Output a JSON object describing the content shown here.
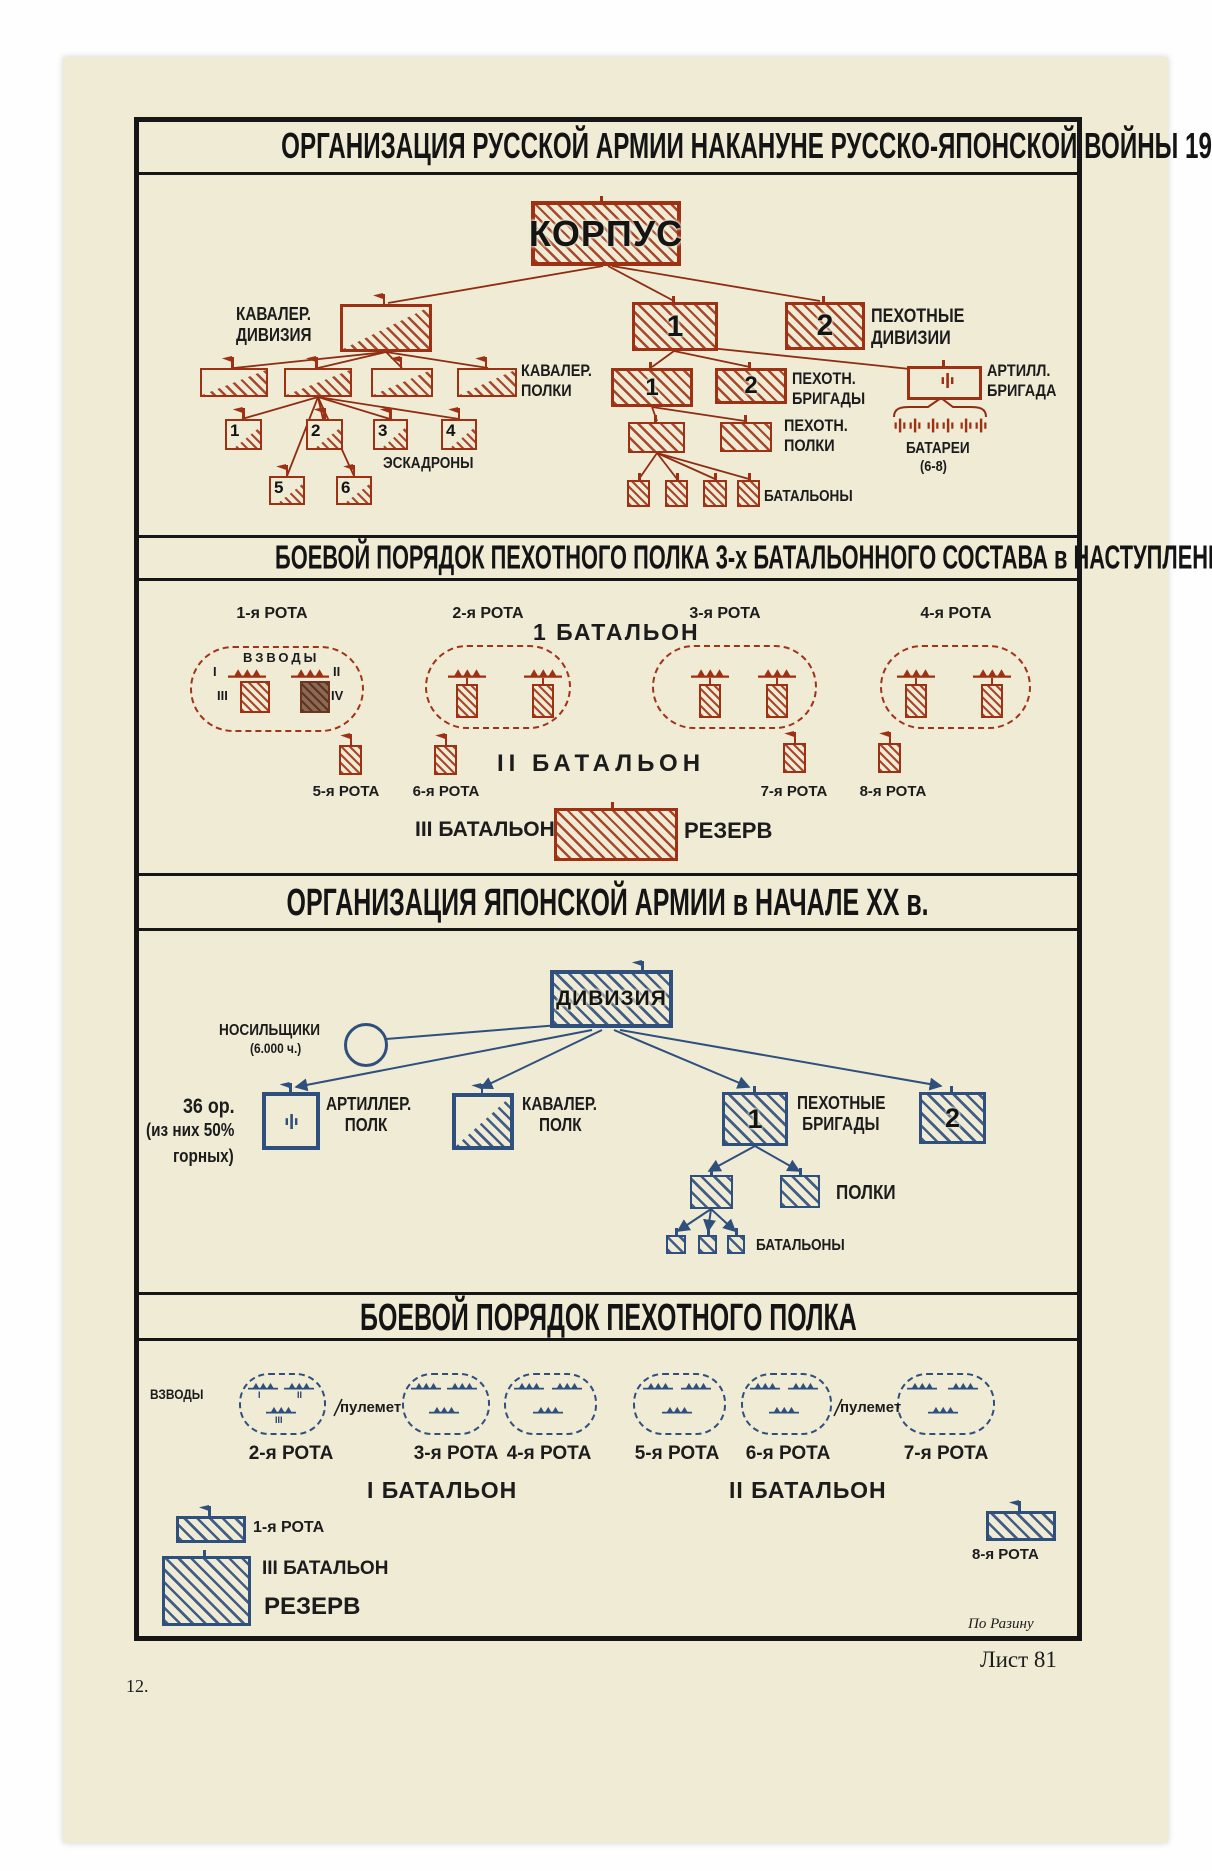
{
  "colors": {
    "paper": "#efebd5",
    "red_ink": "#9e3014",
    "blue_ink": "#2f4f7d",
    "text_ink": "#1c1c1c"
  },
  "titles": {
    "s1": "ОРГАНИЗАЦИЯ РУССКОЙ АРМИИ НАКАНУНЕ РУССКО-ЯПОНСКОЙ ВОЙНЫ 1904-5г.г.",
    "s2": "БОЕВОЙ ПОРЯДОК ПЕХОТНОГО ПОЛКА 3-х БАТАЛЬОННОГО СОСТАВА в НАСТУПЛЕНИИ",
    "s3": "ОРГАНИЗАЦИЯ ЯПОНСКОЙ АРМИИ в НАЧАЛЕ XX в.",
    "s4": "БОЕВОЙ ПОРЯДОК ПЕХОТНОГО ПОЛКА"
  },
  "ru_org": {
    "korpus": "КОРПУС",
    "cav_div_l1": "КАВАЛЕР.",
    "cav_div_l2": "ДИВИЗИЯ",
    "cav_reg_l1": "КАВАЛЕР.",
    "cav_reg_l2": "ПОЛКИ",
    "squadrons_label": "ЭСКАДРОНЫ",
    "squadron_numbers": [
      "1",
      "2",
      "3",
      "4",
      "5",
      "6"
    ],
    "inf_div_l1": "ПЕХОТНЫЕ",
    "inf_div_l2": "ДИВИЗИИ",
    "inf_div_numbers": [
      "1",
      "2"
    ],
    "inf_brig_l1": "ПЕХОТН.",
    "inf_brig_l2": "БРИГАДЫ",
    "inf_brig_numbers": [
      "1",
      "2"
    ],
    "art_brig_l1": "АРТИЛЛ.",
    "art_brig_l2": "БРИГАДА",
    "batteries_label": "БАТАРЕИ",
    "batteries_count": "(6-8)",
    "inf_reg_l1": "ПЕХОТН.",
    "inf_reg_l2": "ПОЛКИ",
    "battalions_label": "БАТАЛЬОНЫ"
  },
  "ru_battle": {
    "companies_row1": [
      "1-я РОТА",
      "2-я РОТА",
      "3-я РОТА",
      "4-я РОТА"
    ],
    "battalion1": "1 БАТАЛЬОН",
    "platoons_label": "ВЗВОДЫ",
    "platoon_numerals": [
      "I",
      "II",
      "III",
      "IV"
    ],
    "companies_row2": [
      "5-я РОТА",
      "6-я РОТА",
      "7-я РОТА",
      "8-я РОТА"
    ],
    "battalion2": "II БАТАЛЬОН",
    "battalion3": "III БАТАЛЬОН",
    "reserve": "РЕЗЕРВ"
  },
  "jp_org": {
    "division": "ДИВИЗИЯ",
    "porters_l1": "НОСИЛЬЩИКИ",
    "porters_l2": "(6.000 ч.)",
    "guns_l1": "36 ор.",
    "guns_l2": "(из них 50%",
    "guns_l3": "горных)",
    "art_reg_l1": "АРТИЛЛЕР.",
    "art_reg_l2": "ПОЛК",
    "cav_reg_l1": "КАВАЛЕР.",
    "cav_reg_l2": "ПОЛК",
    "inf_brig_l1": "ПЕХОТНЫЕ",
    "inf_brig_l2": "БРИГАДЫ",
    "inf_brig_numbers": [
      "1",
      "2"
    ],
    "regiments_label": "ПОЛКИ",
    "battalions_label": "БАТАЛЬОНЫ"
  },
  "jp_battle": {
    "platoons_label": "ВЗВОДЫ",
    "mg_label": "пулемет",
    "companies": [
      "2-я РОТА",
      "3-я РОТА",
      "4-я РОТА",
      "5-я РОТА",
      "6-я РОТА",
      "7-я РОТА"
    ],
    "battalion1": "I БАТАЛЬОН",
    "battalion2": "II БАТАЛЬОН",
    "battalion3": "III БАТАЛЬОН",
    "company1": "1-я РОТА",
    "company8": "8-я РОТА",
    "reserve": "РЕЗЕРВ",
    "platoon_numerals": [
      "I",
      "II",
      "III"
    ]
  },
  "footer": {
    "credit": "По Разину",
    "sheet": "Лист 81",
    "page": "12."
  }
}
